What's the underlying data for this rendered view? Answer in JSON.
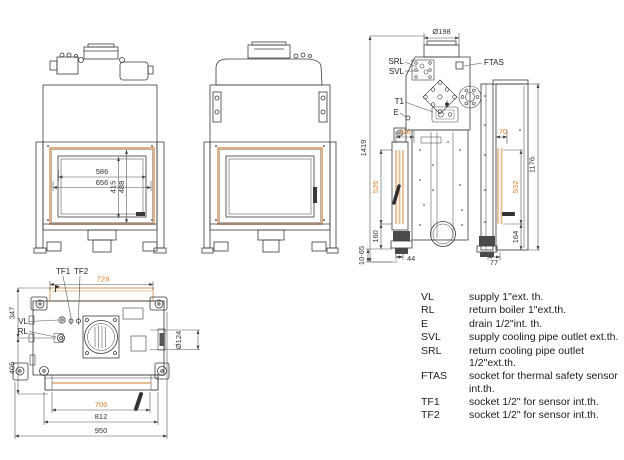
{
  "colors": {
    "accent_orange": "#E0802F",
    "frame_tan": "#E2A873",
    "line": "#3b3b3b"
  },
  "views": {
    "front": {
      "dims": {
        "d586": "586",
        "d656": "656",
        "d415": "415",
        "d488": "488"
      }
    },
    "rear": {
      "labels": {
        "dia": "Ø198",
        "srl": "SRL",
        "svl": "SVL",
        "ftas": "FTAS",
        "t1": "T1",
        "e": "E"
      },
      "dims": {
        "d1419": "1419",
        "d116": "116",
        "d70": "70",
        "d526": "526",
        "d532": "532",
        "d1176": "1176",
        "d160": "160",
        "d164": "164",
        "d1065": "10-65",
        "d44": "44",
        "d77": "77"
      }
    },
    "plan": {
      "labels": {
        "tf1": "TF1",
        "tf2": "TF2",
        "vl": "VL",
        "rl": "RL",
        "dia": "Ø124"
      },
      "dims": {
        "d729": "729",
        "d347": "347",
        "d405": "405",
        "d706": "706",
        "d812": "812",
        "d950": "950"
      }
    }
  },
  "legend": {
    "items": [
      {
        "abbr": "VL",
        "desc": "supply 1\"ext. th."
      },
      {
        "abbr": "RL",
        "desc": "return boiler 1\"ext.th."
      },
      {
        "abbr": "E",
        "desc": "drain 1/2\"int. th."
      },
      {
        "abbr": "SVL",
        "desc": "supply cooling pipe outlet ext.th."
      },
      {
        "abbr": "SRL",
        "desc": "return cooling pipe outlet 1/2\"ext.th."
      },
      {
        "abbr": "FTAS",
        "desc": "socket for thermal safety sensor int.th."
      },
      {
        "abbr": "TF1",
        "desc": "socket 1/2\" for sensor int.th."
      },
      {
        "abbr": "TF2",
        "desc": "socket 1/2\" for sensor int.th."
      }
    ]
  }
}
